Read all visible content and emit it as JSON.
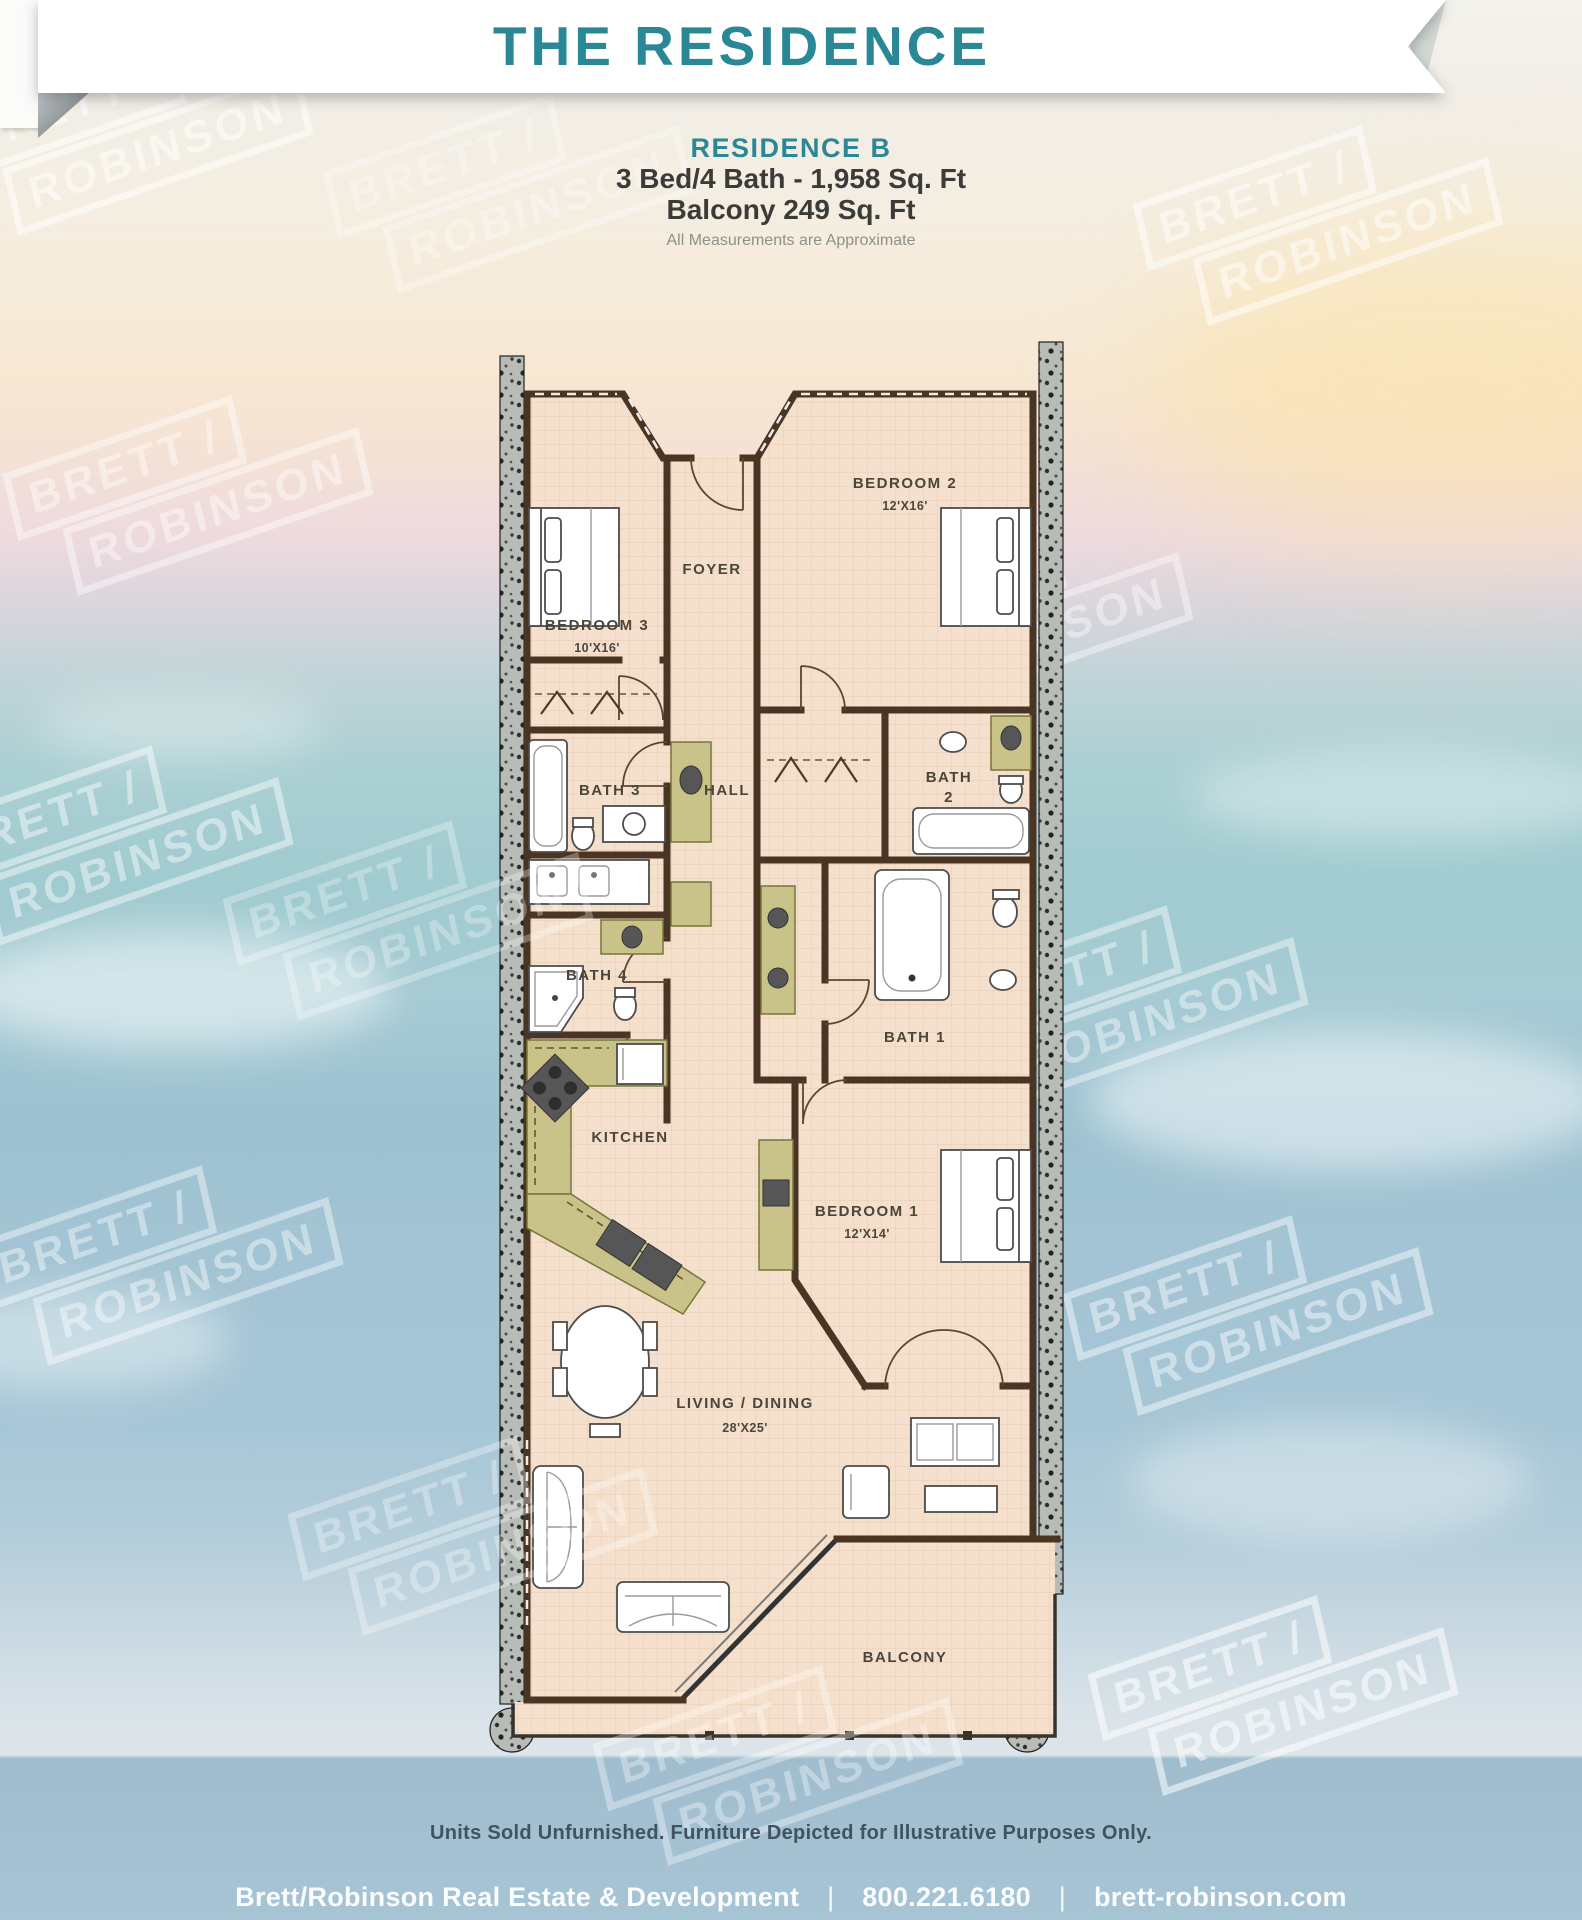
{
  "header": {
    "banner_title": "THE RESIDENCE",
    "residence_name": "RESIDENCE B",
    "spec_bed_bath": "3 Bed/4 Bath - 1,958 Sq. Ft",
    "spec_balcony": "Balcony 249 Sq. Ft",
    "measurements_note": "All Measurements are Approximate"
  },
  "floorplan": {
    "watermark": {
      "line1": "BRETT /",
      "line2": "ROBINSON"
    },
    "rooms": {
      "bedroom2": {
        "name": "BEDROOM 2",
        "dims": "12'X16'"
      },
      "foyer": {
        "name": "FOYER"
      },
      "bedroom3": {
        "name": "BEDROOM 3",
        "dims": "10'X16'"
      },
      "bath3": {
        "name": "BATH 3"
      },
      "hall": {
        "name": "HALL"
      },
      "bath2": {
        "line1": "BATH",
        "line2": "2"
      },
      "bath4": {
        "name": "BATH 4"
      },
      "bath1": {
        "name": "BATH 1"
      },
      "kitchen": {
        "name": "KITCHEN"
      },
      "bedroom1": {
        "name": "BEDROOM 1",
        "dims": "12'X14'"
      },
      "living": {
        "name": "LIVING / DINING",
        "dims": "28'X25'"
      },
      "balcony": {
        "name": "BALCONY"
      }
    }
  },
  "footer": {
    "disclaimer": "Units Sold Unfurnished. Furniture Depicted for Illustrative Purposes Only.",
    "company": "Brett/Robinson Real Estate & Development",
    "phone": "800.221.6180",
    "website": "brett-robinson.com",
    "separator": "|"
  },
  "colors": {
    "accent_teal": "#2a8795",
    "wall_brown": "#4a3423",
    "floor_tan": "#f4e0cc",
    "cabinet_olive": "#c9c38a",
    "column_gray": "#b7bcb6",
    "ocean_teal": "#a3cdd2",
    "water_blue": "#a7c6d9",
    "footer_text": "#fafdff",
    "disclaimer_text": "#3f5363"
  }
}
